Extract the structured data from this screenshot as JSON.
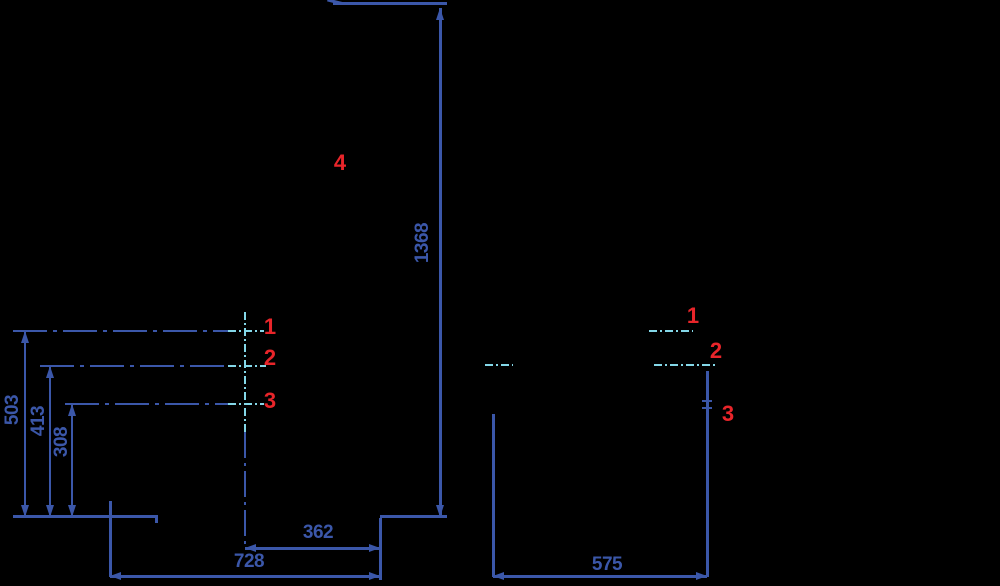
{
  "title": "Appliance installation dimension drawing",
  "colors": {
    "background": "#000000",
    "line_blue": "#3b57a9",
    "axis_cyan": "#84d7e8",
    "marker_red": "#e8252a"
  },
  "side_view": {
    "height_total": "1368",
    "pos1_height": "503",
    "pos2_height": "413",
    "pos3_height": "308",
    "axis_depth": "362",
    "total_depth": "728",
    "marker1": "1",
    "marker2": "2",
    "marker3": "3",
    "marker4": "4"
  },
  "front_view": {
    "total_width": "575",
    "marker1": "1",
    "marker2": "2",
    "marker3": "3"
  }
}
